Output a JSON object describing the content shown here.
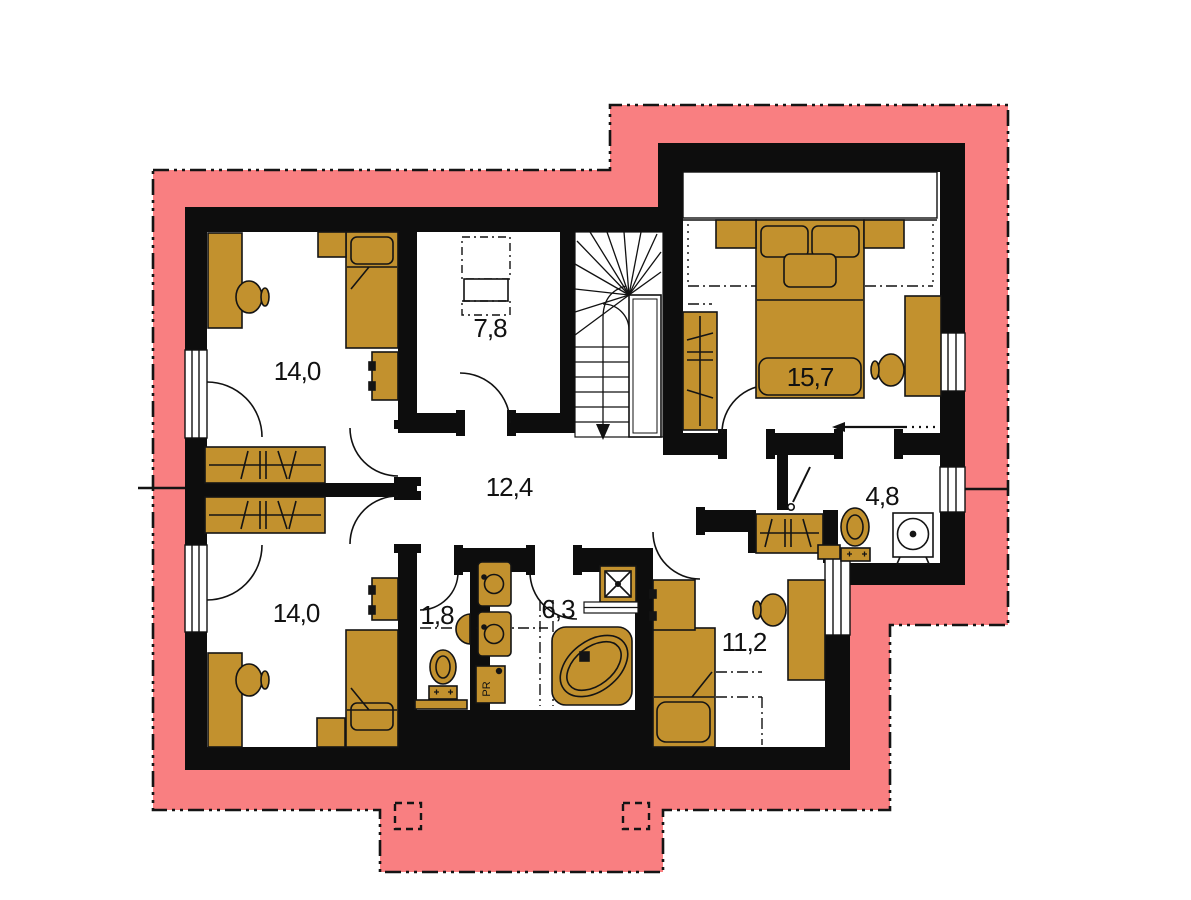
{
  "plan": {
    "type": "floor-plan-upper-storey",
    "colors": {
      "roof_overhang": "#f97f81",
      "walls": "#0d0d0d",
      "furniture": "#c2912e",
      "floor": "#ffffff"
    },
    "rooms": [
      {
        "name": "bedroom-upper-left",
        "area_m2": "14,0"
      },
      {
        "name": "room-upper-middle",
        "area_m2": "7,8"
      },
      {
        "name": "bedroom-upper-right",
        "area_m2": "15,7"
      },
      {
        "name": "hallway",
        "area_m2": "12,4"
      },
      {
        "name": "bedroom-lower-left",
        "area_m2": "14,0"
      },
      {
        "name": "wc",
        "area_m2": "1,8"
      },
      {
        "name": "bathroom",
        "area_m2": "6,3"
      },
      {
        "name": "shower-room",
        "area_m2": "4,8"
      },
      {
        "name": "bedroom-lower-right",
        "area_m2": "11,2"
      }
    ],
    "appliance_labels": {
      "washer": "PR"
    }
  }
}
